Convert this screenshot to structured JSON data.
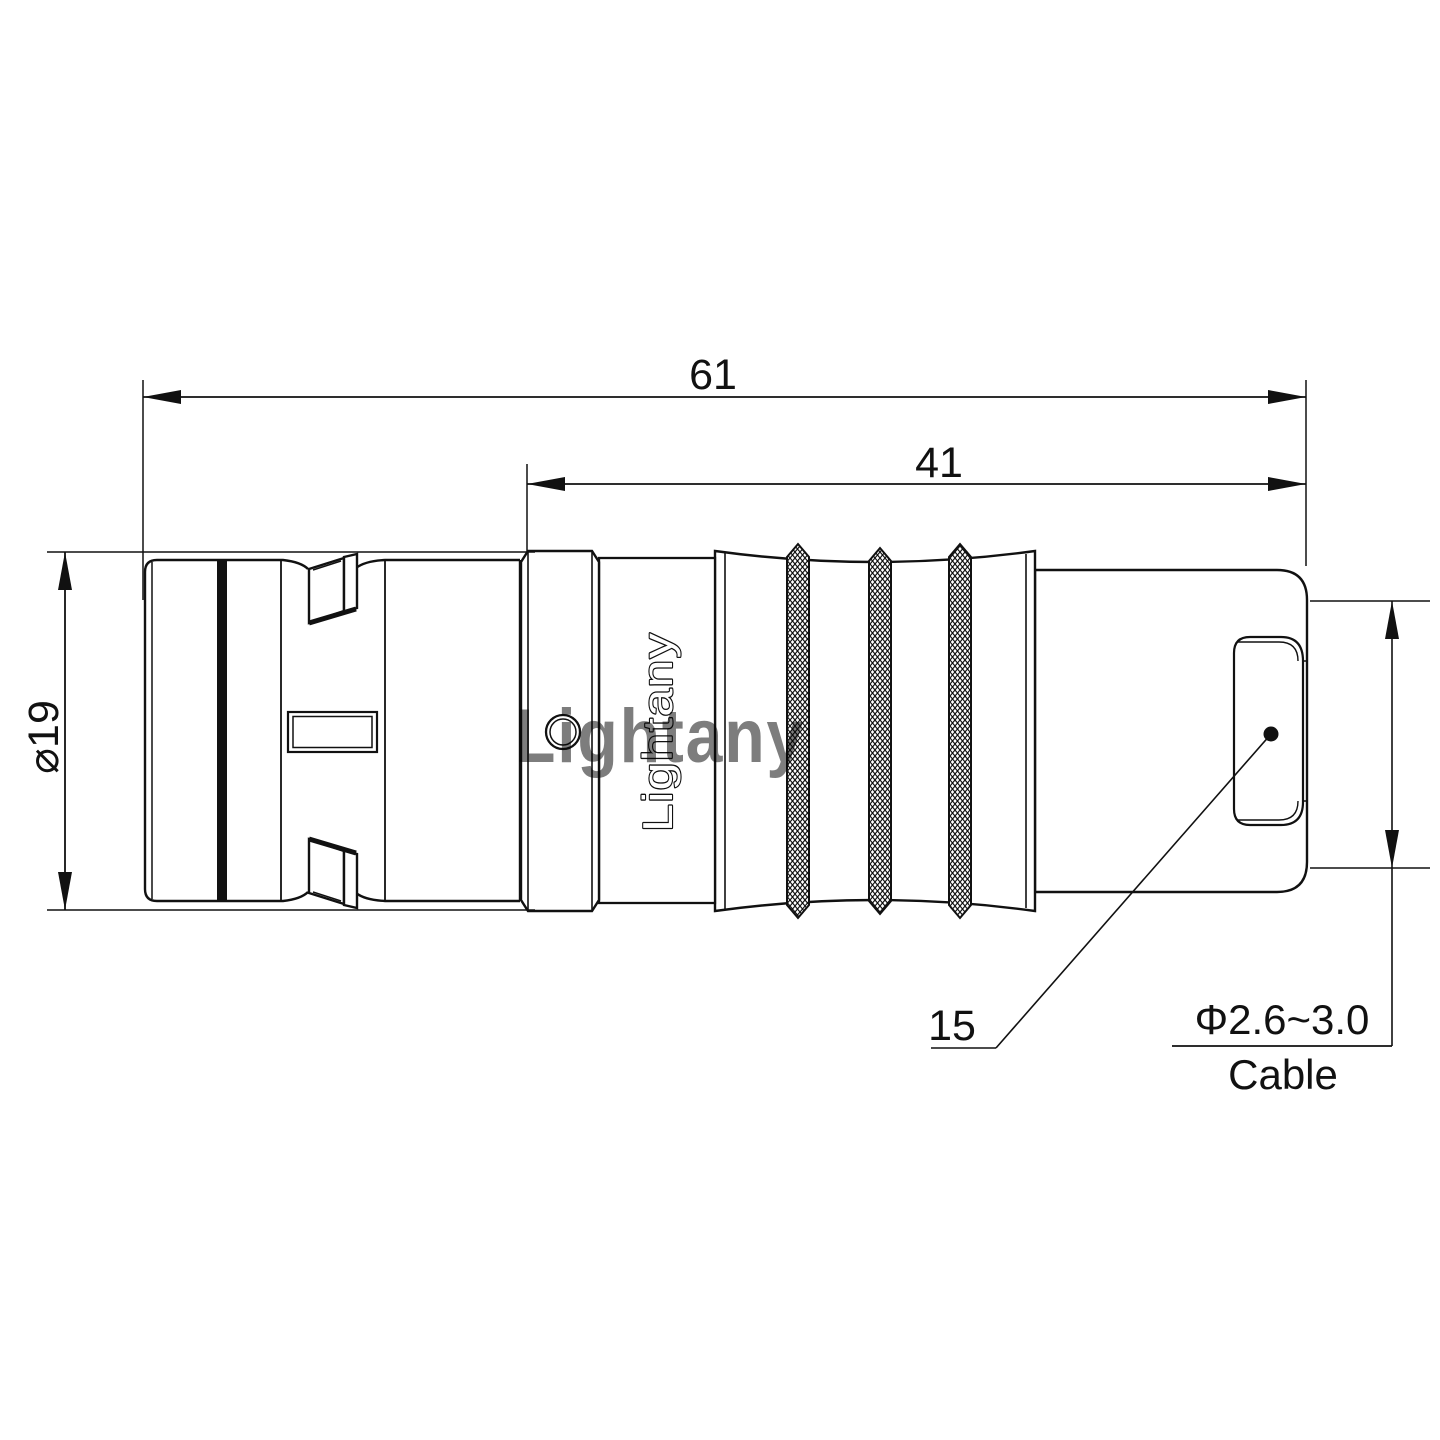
{
  "drawing": {
    "background": "#ffffff",
    "stroke_color": "#111111",
    "dimensions": {
      "overall_length": "61",
      "rear_length": "41",
      "outer_diameter": "⌀19",
      "item_callout": "15",
      "cable_diameter_range": "Φ2.6~3.0",
      "cable_label": "Cable"
    },
    "branding": {
      "body_text": "Lightany",
      "watermark_text": "Lightany",
      "watermark_color": "#ef9a9a"
    }
  }
}
